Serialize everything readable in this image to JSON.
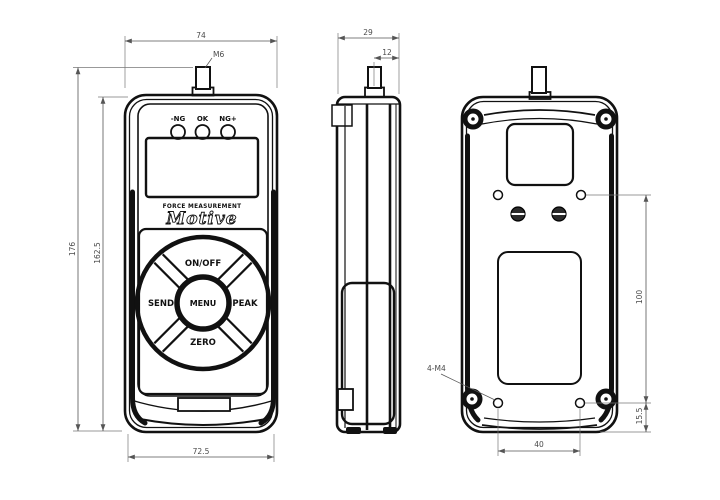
{
  "drawing": {
    "type": "technical-drawing",
    "subject": "digital force gauge, front / side / back views"
  },
  "dimensions": {
    "front_width": "74",
    "shaft_thread": "M6",
    "total_height": "176",
    "body_height": "162.5",
    "bottom_width": "72.5",
    "side_depth": "29",
    "shaft_offset": "12",
    "mount_hole_vertical_spacing": "100",
    "mount_hole_bottom_offset": "15.5",
    "mount_hole_horizontal_spacing": "40",
    "mount_thread": "4-M4"
  },
  "front": {
    "indicator_labels": [
      "-NG",
      "OK",
      "NG+"
    ],
    "brand_caption": "FORCE MEASUREMENT",
    "brand_name": "Motive",
    "buttons": {
      "top": "ON/OFF",
      "left": "SEND",
      "center": "MENU",
      "right": "PEAK",
      "bottom": "ZERO"
    }
  },
  "colors": {
    "background": "#ffffff",
    "outline": "#111111",
    "dimension_line": "#666666",
    "dimension_text": "#4a4a4a"
  }
}
